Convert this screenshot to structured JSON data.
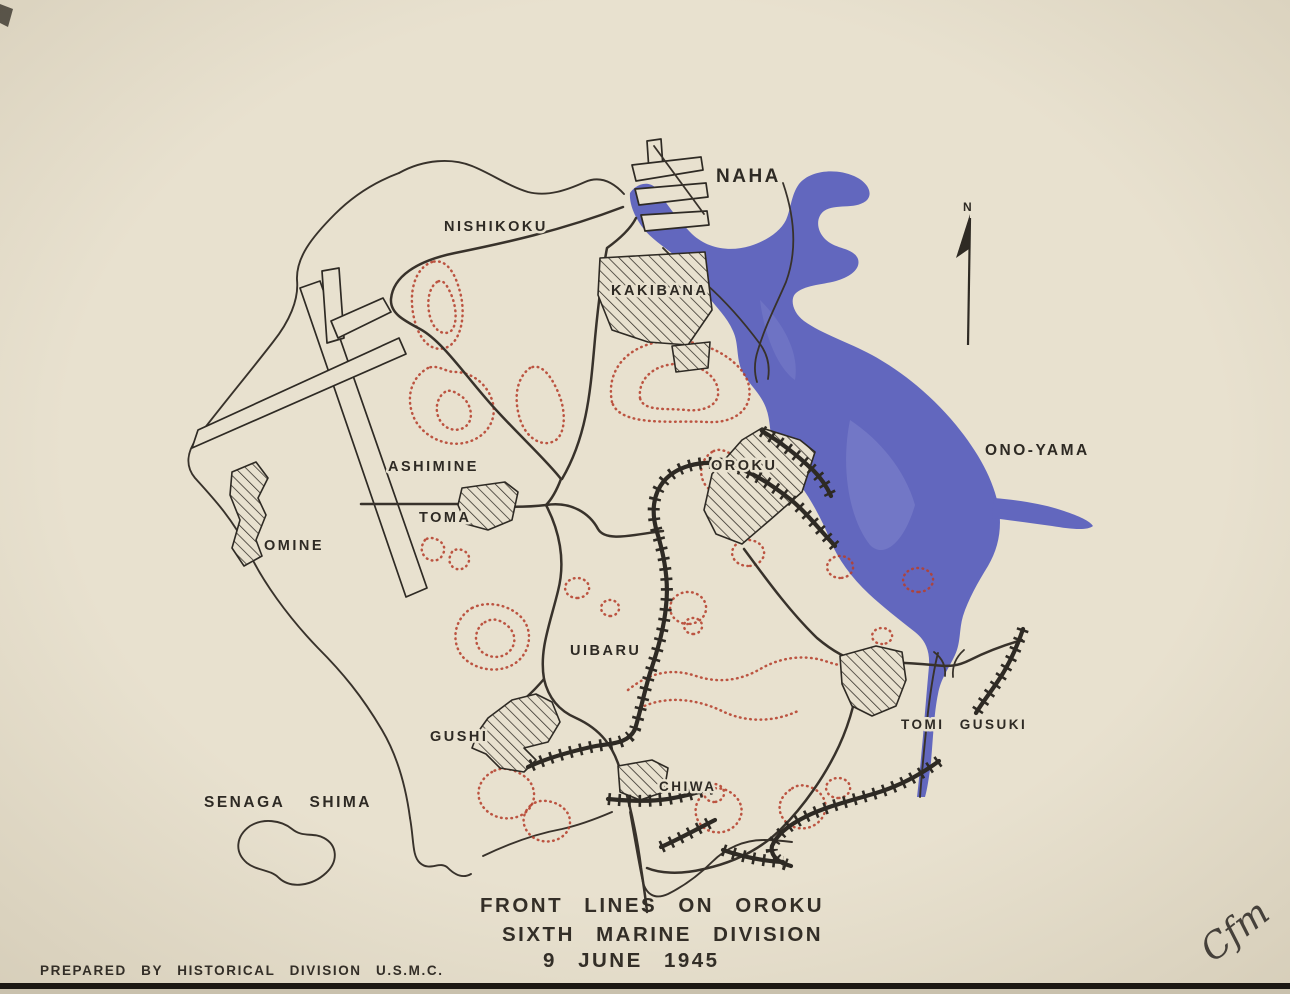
{
  "map": {
    "title_lines": [
      "FRONT LINES ON OROKU",
      "SIXTH MARINE DIVISION",
      "9 JUNE 1945"
    ],
    "credit": "PREPARED BY HISTORICAL DIVISION U.S.M.C.",
    "signature": "Cfm",
    "north_label": "N",
    "labels": {
      "naha": "NAHA",
      "nishikoku": "NISHIKOKU",
      "kakibana": "KAKIBANA",
      "ashimine": "ASHIMINE",
      "toma": "TOMA",
      "omine": "OMINE",
      "oroku": "OROKU",
      "ono_yama": "ONO-YAMA",
      "uibaru": "UIBARU",
      "gushi": "GUSHI",
      "tomi_gusuki": "TOMI GUSUKI",
      "chiwa": "CHIWA",
      "senaga_shima": "SENAGA SHIMA"
    },
    "features": {
      "water_name": "Naha harbor and Kokuba estuary",
      "front_line_symbol": "hachured front line",
      "town_symbol": "diagonal-hatched built-up area"
    },
    "colors": {
      "paper": "#e8e1cf",
      "ink": "#2e2a24",
      "water": "#6267be",
      "contour": "#b5402e"
    }
  }
}
